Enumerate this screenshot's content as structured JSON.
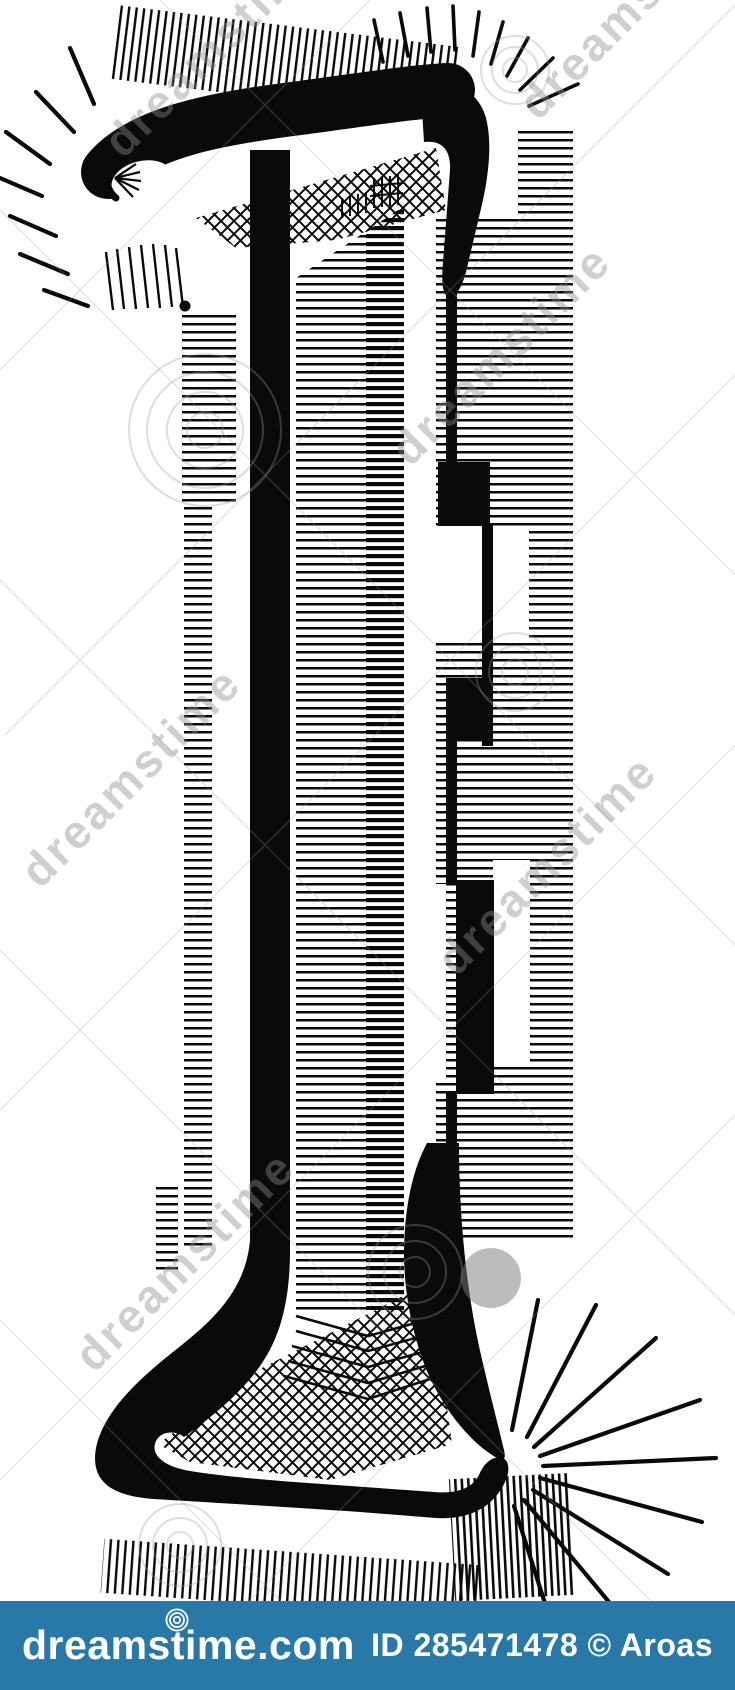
{
  "page": {
    "width": 735,
    "height": 1690,
    "background": "#ffffff"
  },
  "artwork": {
    "label": "Black and white font stroke line drawing of the number 1",
    "numeral": "1",
    "ink_color": "#0a0a0a"
  },
  "watermark": {
    "text": "dreamstime",
    "color": "#8c8c8c"
  },
  "footer": {
    "background": "#2878a8",
    "logo_text": "dreamstime.com",
    "credit_text": "ID 285471478 © Aroas",
    "text_color": "#ffffff"
  }
}
